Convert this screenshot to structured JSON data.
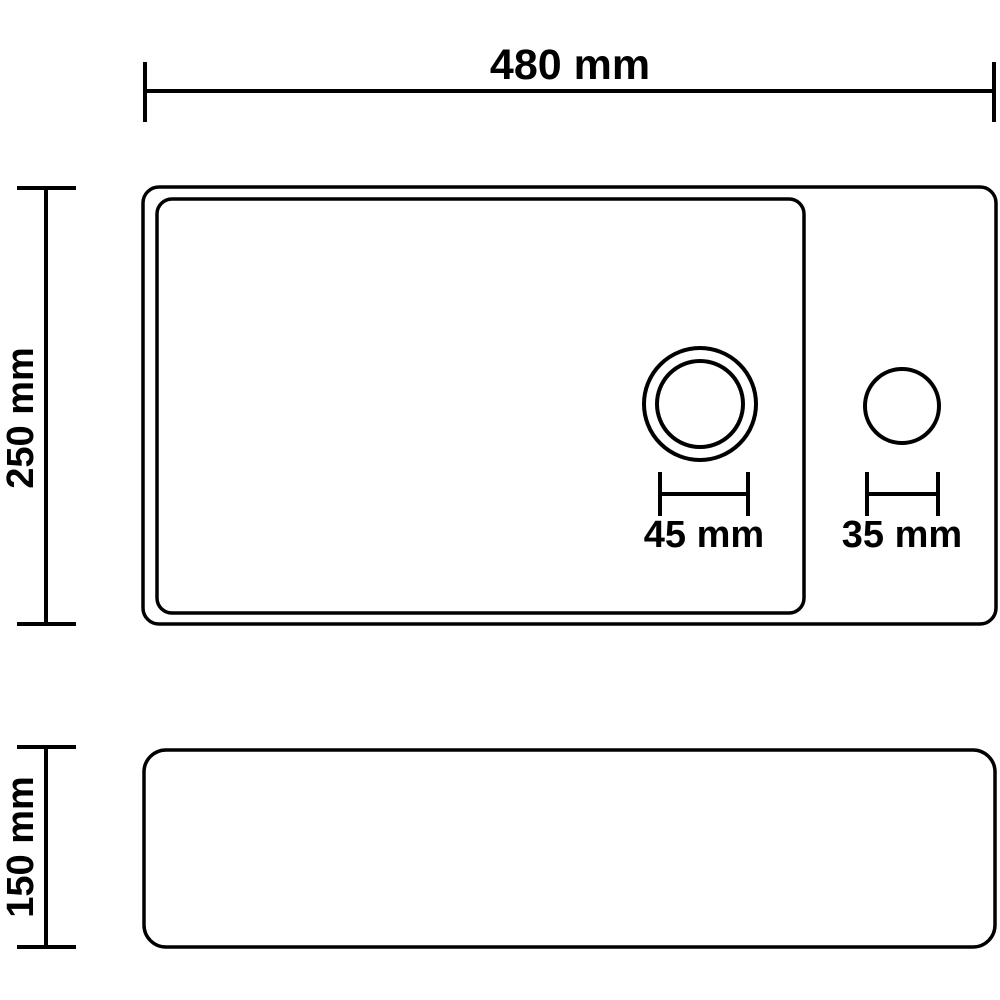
{
  "diagram": {
    "subject": "washbasin-technical-dimension-drawing",
    "background_color": "#ffffff",
    "line_color": "#000000",
    "views": {
      "top_view": "basin top view with drain hole and tap hole",
      "side_view": "basin side profile"
    },
    "labels": {
      "overall_width": "480 mm",
      "overall_depth": "250 mm",
      "basin_height": "150 mm",
      "drain_hole_diameter": "45 mm",
      "tap_hole_diameter": "35 mm"
    }
  }
}
